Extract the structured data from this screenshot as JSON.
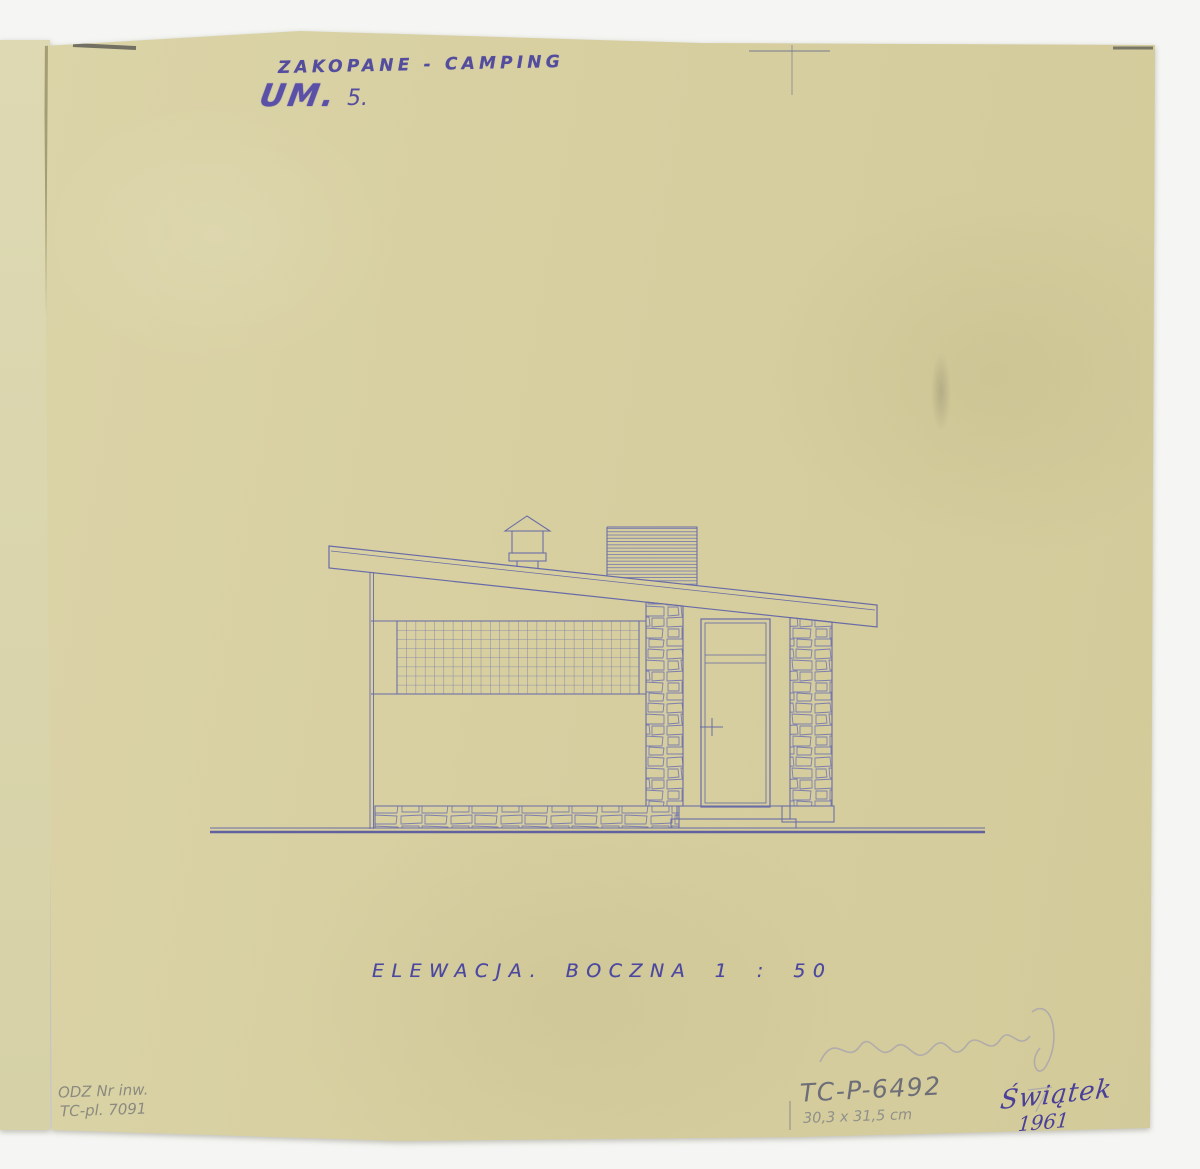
{
  "sheet": {
    "paper_color": "#d7cfa0",
    "ink_color": "#5f63a8",
    "pencil_color": "#8b8a80"
  },
  "header": {
    "title": "ZAKOPANE - CAMPING",
    "stamp": "UM.",
    "stamp_number": "5."
  },
  "caption": {
    "text": "ELEWACJA. BOCZNA 1 : 50"
  },
  "drawing": {
    "name": "side-elevation",
    "scale": "1:50",
    "elements": [
      "shed-roof",
      "roof-vent",
      "roof-louver",
      "glass-block-window-grid",
      "stone-pillars",
      "door-with-transom",
      "stone-foundation",
      "entry-step",
      "ground-line"
    ]
  },
  "annotations": {
    "inventory_line1": "ODZ Nr inw.",
    "inventory_line2": "TC-pl. 7091",
    "catalog_number": "TC-P-6492",
    "dimensions": "30,3 x 31,5 cm",
    "signature": "Świątek",
    "year": "1961"
  }
}
